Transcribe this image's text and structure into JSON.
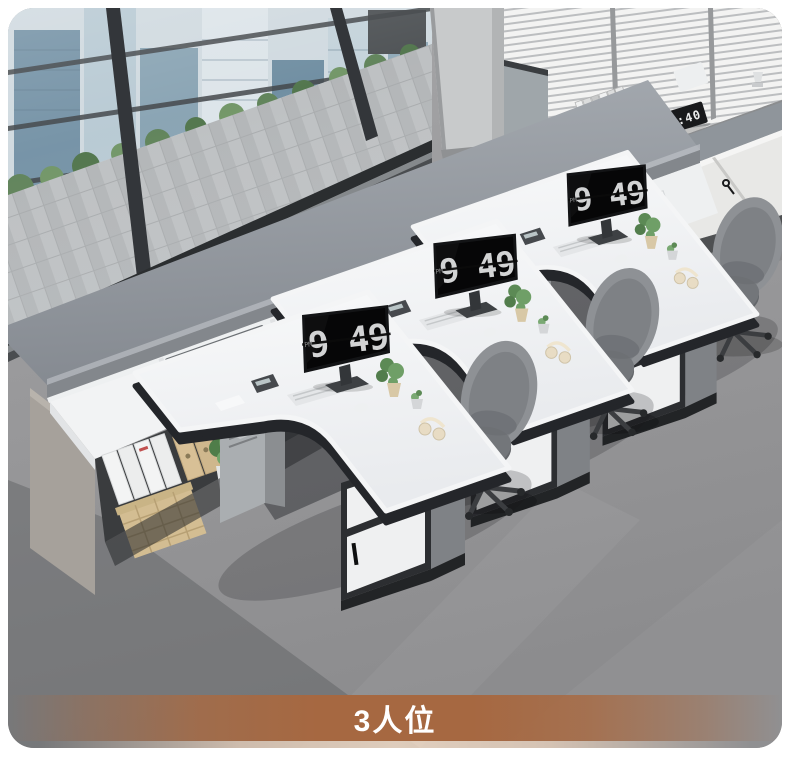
{
  "banner": {
    "label": "3人位",
    "color": "#a96a42",
    "text_color": "#ffffff"
  },
  "workstations": [
    {
      "id": 1,
      "monitor_time": "9 49",
      "monitor_period": "PM"
    },
    {
      "id": 2,
      "monitor_time": "9 49",
      "monitor_period": "PM"
    },
    {
      "id": 3,
      "monitor_time": "9 49",
      "monitor_period": "PM"
    }
  ],
  "back_cabinet": {
    "clock_time": "12:40"
  },
  "palette": {
    "floor": "#98989a",
    "credenza_top": "#8f949a",
    "desk_surface": "#f4f5f6",
    "desk_edge": "#2a2c2e",
    "cabinet_white": "#eff0f1",
    "chair_gray": "#8b8e92",
    "screen_black": "#0a0a0b",
    "plant_green": "#5f8f58",
    "basket_tan": "#d3bd92",
    "banner_brown": "#a96a42"
  },
  "objects": [
    "city-window-wall",
    "window-blinds",
    "concrete-column",
    "carpet-tile-floor",
    "back-cabinet-row",
    "desk-clock",
    "book-stack",
    "storage-box",
    "long-credenza-hutch",
    "printer",
    "wire-document-trays",
    "paper-stacks",
    "file-binders",
    "kraft-folders",
    "wicker-basket",
    "potted-plants",
    "l-shaped-desk",
    "flip-clock-monitor",
    "keyboard",
    "mouse",
    "calculator",
    "headphones",
    "office-chair",
    "drawer-pedestal",
    "pc-tower"
  ]
}
